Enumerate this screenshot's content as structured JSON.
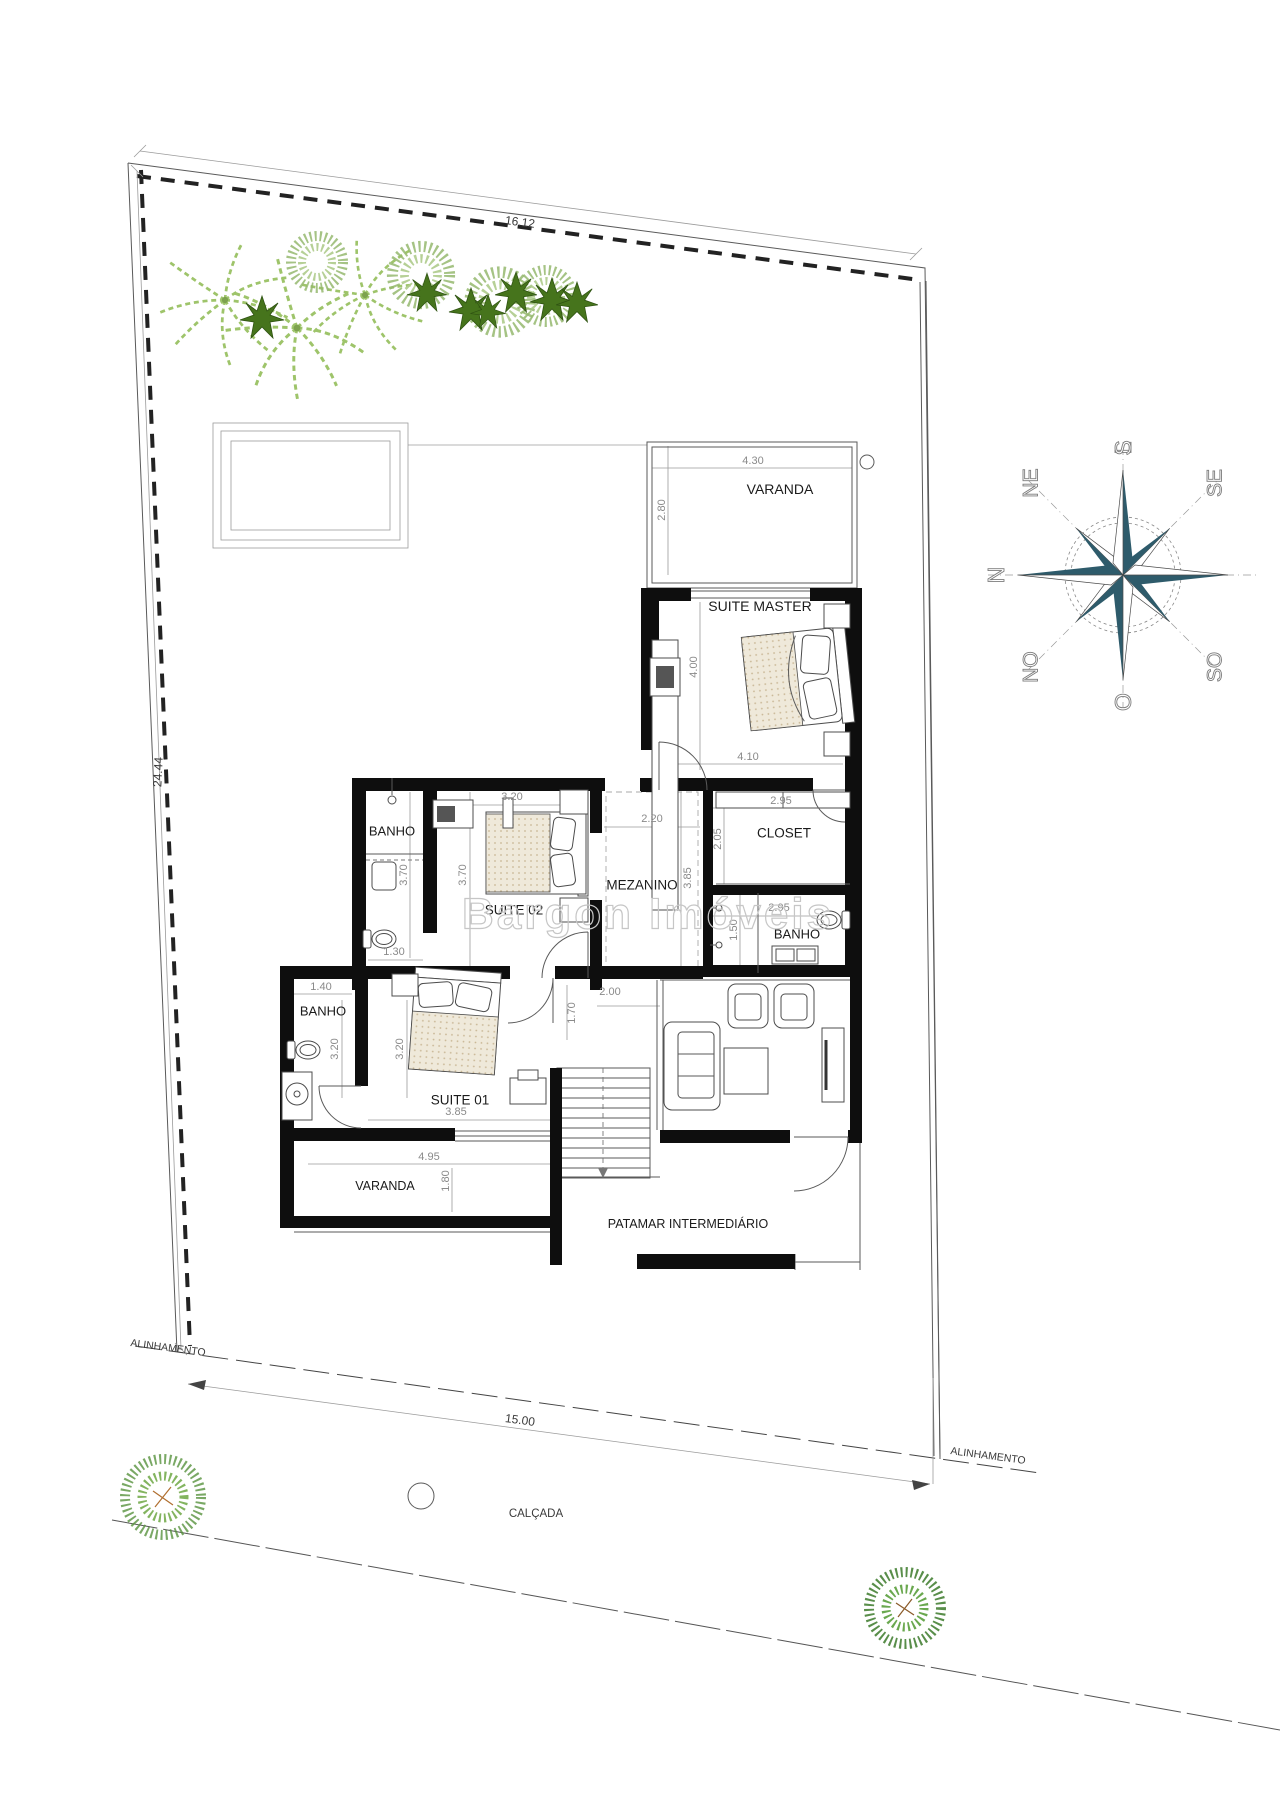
{
  "title": "Planta de pavimento superior - casa",
  "watermark": "Bargon Imóveis",
  "site": {
    "top_dimension": "16.12",
    "side_dimension": "24.44",
    "front_dimension": "15.00",
    "alignment_label": "ALINHAMENTO",
    "sidewalk_label": "CALÇADA"
  },
  "rooms": [
    {
      "name": "VARANDA",
      "width": "4.30",
      "depth": "2.80"
    },
    {
      "name": "SUITE MASTER",
      "width": "4.10",
      "depth": "4.00"
    },
    {
      "name": "CLOSET",
      "width": "2.95",
      "depth": "2.05"
    },
    {
      "name": "BANHO (suite master)",
      "width": "2.95",
      "depth": "1.50"
    },
    {
      "name": "MEZANINO",
      "width": "2.20",
      "depth": "3.85"
    },
    {
      "name": "SUITE 02",
      "width": "3.20",
      "depth": "3.70"
    },
    {
      "name": "BANHO (suite 02)",
      "width": "1.30",
      "depth": "3.70"
    },
    {
      "name": "BANHO (suite 01)",
      "width": "1.40",
      "depth": "3.20"
    },
    {
      "name": "SUITE 01",
      "width": "3.85",
      "depth": "3.20"
    },
    {
      "name": "VARANDA (suite 01)",
      "width": "4.95",
      "depth": "1.80"
    },
    {
      "name": "PATAMAR INTERMEDIÁRIO"
    },
    {
      "name": "HALL / ESCADA",
      "width": "2.00",
      "depth": "1.70"
    }
  ],
  "compass": {
    "points": [
      "N",
      "NE",
      "L",
      "SE",
      "S",
      "SO",
      "O",
      "NO"
    ],
    "star_color": "#2e5b6b"
  },
  "colors": {
    "wall": "#0e0e0e",
    "room_text": "#1b1b1b",
    "dim_text": "#8a8a8a",
    "compass_teal": "#2e5b6b",
    "palm_green": "#9ec46a",
    "bush_green": "#95b96e",
    "star_plant_green": "#46741c",
    "bed_fill": "#efe9da"
  },
  "labels": [
    {
      "t": "VARANDA",
      "x": 780,
      "y": 489,
      "s": 14,
      "c": "room",
      "n": "room-label-varanda-top"
    },
    {
      "t": "SUITE MASTER",
      "x": 760,
      "y": 606,
      "s": 14,
      "c": "room",
      "n": "room-label-suite-master"
    },
    {
      "t": "CLOSET",
      "x": 784,
      "y": 833,
      "s": 13.5,
      "c": "room",
      "n": "room-label-closet"
    },
    {
      "t": "BANHO",
      "x": 797,
      "y": 934,
      "s": 13,
      "c": "room",
      "n": "room-label-banho-master"
    },
    {
      "t": "MEZANINO",
      "x": 642,
      "y": 885,
      "s": 13.5,
      "c": "room",
      "n": "room-label-mezanino"
    },
    {
      "t": "SUITE 02",
      "x": 514,
      "y": 910,
      "s": 13.5,
      "c": "room",
      "n": "room-label-suite-02"
    },
    {
      "t": "BANHO",
      "x": 392,
      "y": 831,
      "s": 13,
      "c": "room",
      "n": "room-label-banho-02"
    },
    {
      "t": "BANHO",
      "x": 323,
      "y": 1011,
      "s": 13,
      "c": "room",
      "n": "room-label-banho-01"
    },
    {
      "t": "SUITE 01",
      "x": 460,
      "y": 1100,
      "s": 13.5,
      "c": "room",
      "n": "room-label-suite-01"
    },
    {
      "t": "VARANDA",
      "x": 385,
      "y": 1186,
      "s": 12.5,
      "c": "room",
      "n": "room-label-varanda-bottom"
    },
    {
      "t": "PATAMAR INTERMEDIÁRIO",
      "x": 688,
      "y": 1224,
      "s": 12.5,
      "c": "room",
      "n": "room-label-patamar"
    },
    {
      "t": "4.30",
      "x": 753,
      "y": 461,
      "s": 11,
      "c": "dim",
      "n": "dim-label"
    },
    {
      "t": "2.80",
      "x": 662,
      "y": 510,
      "s": 11,
      "r": -90,
      "c": "dim",
      "n": "dim-label"
    },
    {
      "t": "4.00",
      "x": 694,
      "y": 667,
      "s": 11,
      "r": -90,
      "c": "dim",
      "n": "dim-label"
    },
    {
      "t": "4.10",
      "x": 748,
      "y": 757,
      "s": 11,
      "c": "dim",
      "n": "dim-label"
    },
    {
      "t": "2.95",
      "x": 781,
      "y": 801,
      "s": 11,
      "c": "dim",
      "n": "dim-label"
    },
    {
      "t": "2.05",
      "x": 718,
      "y": 839,
      "s": 11,
      "r": -90,
      "c": "dim",
      "n": "dim-label"
    },
    {
      "t": "2.95",
      "x": 779,
      "y": 908,
      "s": 11,
      "c": "dim",
      "n": "dim-label"
    },
    {
      "t": "1.50",
      "x": 734,
      "y": 930,
      "s": 11,
      "r": -90,
      "c": "dim",
      "n": "dim-label"
    },
    {
      "t": "2.20",
      "x": 652,
      "y": 819,
      "s": 11,
      "c": "dim",
      "n": "dim-label"
    },
    {
      "t": "3.85",
      "x": 688,
      "y": 878,
      "s": 11,
      "r": -90,
      "c": "dim",
      "n": "dim-label"
    },
    {
      "t": "3.20",
      "x": 512,
      "y": 797,
      "s": 11,
      "c": "dim",
      "n": "dim-label"
    },
    {
      "t": "3.70",
      "x": 463,
      "y": 875,
      "s": 11,
      "r": -90,
      "c": "dim",
      "n": "dim-label"
    },
    {
      "t": "3.70",
      "x": 404,
      "y": 875,
      "s": 11,
      "r": -90,
      "c": "dim",
      "n": "dim-label"
    },
    {
      "t": "1.30",
      "x": 394,
      "y": 952,
      "s": 11,
      "c": "dim",
      "n": "dim-label"
    },
    {
      "t": "1.40",
      "x": 321,
      "y": 987,
      "s": 11,
      "c": "dim",
      "n": "dim-label"
    },
    {
      "t": "3.20",
      "x": 335,
      "y": 1049,
      "s": 11,
      "r": -90,
      "c": "dim",
      "n": "dim-label"
    },
    {
      "t": "3.20",
      "x": 400,
      "y": 1049,
      "s": 11,
      "r": -90,
      "c": "dim",
      "n": "dim-label"
    },
    {
      "t": "3.85",
      "x": 456,
      "y": 1112,
      "s": 11,
      "c": "dim",
      "n": "dim-label"
    },
    {
      "t": "1.70",
      "x": 572,
      "y": 1013,
      "s": 11,
      "r": -90,
      "c": "dim",
      "n": "dim-label"
    },
    {
      "t": "2.00",
      "x": 610,
      "y": 992,
      "s": 11,
      "c": "dim",
      "n": "dim-label"
    },
    {
      "t": "4.95",
      "x": 429,
      "y": 1157,
      "s": 11,
      "c": "dim",
      "n": "dim-label"
    },
    {
      "t": "1.80",
      "x": 446,
      "y": 1181,
      "s": 11,
      "r": -90,
      "c": "dim",
      "n": "dim-label"
    },
    {
      "t": "16.12",
      "x": 520,
      "y": 222,
      "s": 12,
      "r": 7.5,
      "c": "site",
      "n": "site-dim-top"
    },
    {
      "t": "24.44",
      "x": 158,
      "y": 772,
      "s": 12,
      "r": -87,
      "c": "site",
      "n": "site-dim-side"
    },
    {
      "t": "15.00",
      "x": 520,
      "y": 1420,
      "s": 12,
      "r": 7.6,
      "c": "site",
      "n": "site-dim-front"
    },
    {
      "t": "ALINHAMENTO",
      "x": 168,
      "y": 1348,
      "s": 10.5,
      "r": 7.5,
      "c": "site",
      "n": "alignment-label-left"
    },
    {
      "t": "ALINHAMENTO",
      "x": 988,
      "y": 1456,
      "s": 10.5,
      "r": 7.5,
      "c": "site",
      "n": "alignment-label-right"
    },
    {
      "t": "CALÇADA",
      "x": 536,
      "y": 1514,
      "s": 11.5,
      "c": "site",
      "n": "sidewalk-label"
    },
    {
      "t": "Bargon Imóveis",
      "x": 648,
      "y": 914,
      "s": 44,
      "ls": 3,
      "c": "wm",
      "n": "watermark-text"
    },
    {
      "t": "N",
      "x": 0,
      "y": -127,
      "s": 23,
      "c": "compass",
      "layer": "compass",
      "n": "compass-point-n"
    },
    {
      "t": "NE",
      "x": 92,
      "y": -92,
      "s": 21,
      "c": "compass",
      "layer": "compass",
      "n": "compass-point-ne"
    },
    {
      "t": "L",
      "x": 127,
      "y": 0,
      "s": 23,
      "c": "compass",
      "layer": "compass",
      "n": "compass-point-l"
    },
    {
      "t": "SE",
      "x": 92,
      "y": 92,
      "s": 21,
      "c": "compass",
      "layer": "compass",
      "n": "compass-point-se"
    },
    {
      "t": "S",
      "x": 127,
      "y": 0,
      "s": 23,
      "c": "compass",
      "layer": "compass",
      "n": "compass-point-s"
    },
    {
      "t": "SO",
      "x": -92,
      "y": 92,
      "s": 21,
      "c": "compass",
      "layer": "compass",
      "n": "compass-point-so"
    },
    {
      "t": "O",
      "x": -127,
      "y": 0,
      "s": 23,
      "c": "compass",
      "layer": "compass",
      "n": "compass-point-o"
    },
    {
      "t": "NO",
      "x": -92,
      "y": -92,
      "s": 21,
      "c": "compass",
      "layer": "compass",
      "n": "compass-point-no"
    }
  ]
}
